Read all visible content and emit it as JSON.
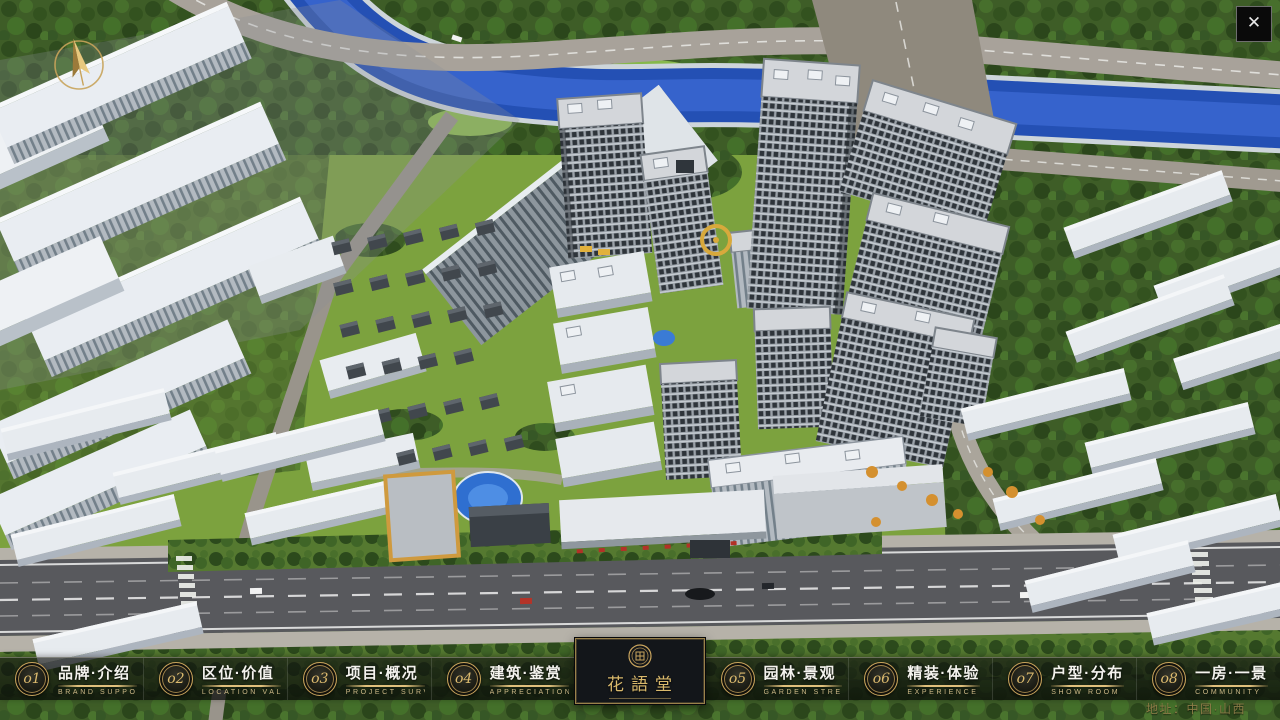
{
  "window": {
    "close_icon": "✕"
  },
  "nav": {
    "items": [
      {
        "num": "o1",
        "title": "品牌·介绍",
        "subtitle": "BRAND SUPPORT"
      },
      {
        "num": "o2",
        "title": "区位·价值",
        "subtitle": "LOCATION VALUE"
      },
      {
        "num": "o3",
        "title": "项目·概况",
        "subtitle": "PROJECT SURVEY"
      },
      {
        "num": "o4",
        "title": "建筑·鉴赏",
        "subtitle": "APPRECIATION"
      },
      {
        "num": "o5",
        "title": "园林·景观",
        "subtitle": "GARDEN STREET"
      },
      {
        "num": "o6",
        "title": "精装·体验",
        "subtitle": "EXPERIENCE"
      },
      {
        "num": "o7",
        "title": "户型·分布",
        "subtitle": "SHOW ROOM"
      },
      {
        "num": "o8",
        "title": "一房·一景",
        "subtitle": "COMMUNITY"
      }
    ]
  },
  "logo": {
    "title": "花語堂"
  },
  "footer": {
    "address": "地址：中国·山西"
  },
  "palette": {
    "gold": "#c9a45c",
    "gold_bright": "#e0c07c",
    "bar_bg": "#0c0e0c",
    "panel_bg": "#13161a",
    "river_blue": "#2450b4",
    "grass_green": "#7ca23e",
    "tree_green": "#3e5d27",
    "road_concrete": "#a8a29a",
    "road_asphalt": "#58595d",
    "building_gray": "#9aa1a8",
    "roof_white": "#e9edf2"
  }
}
